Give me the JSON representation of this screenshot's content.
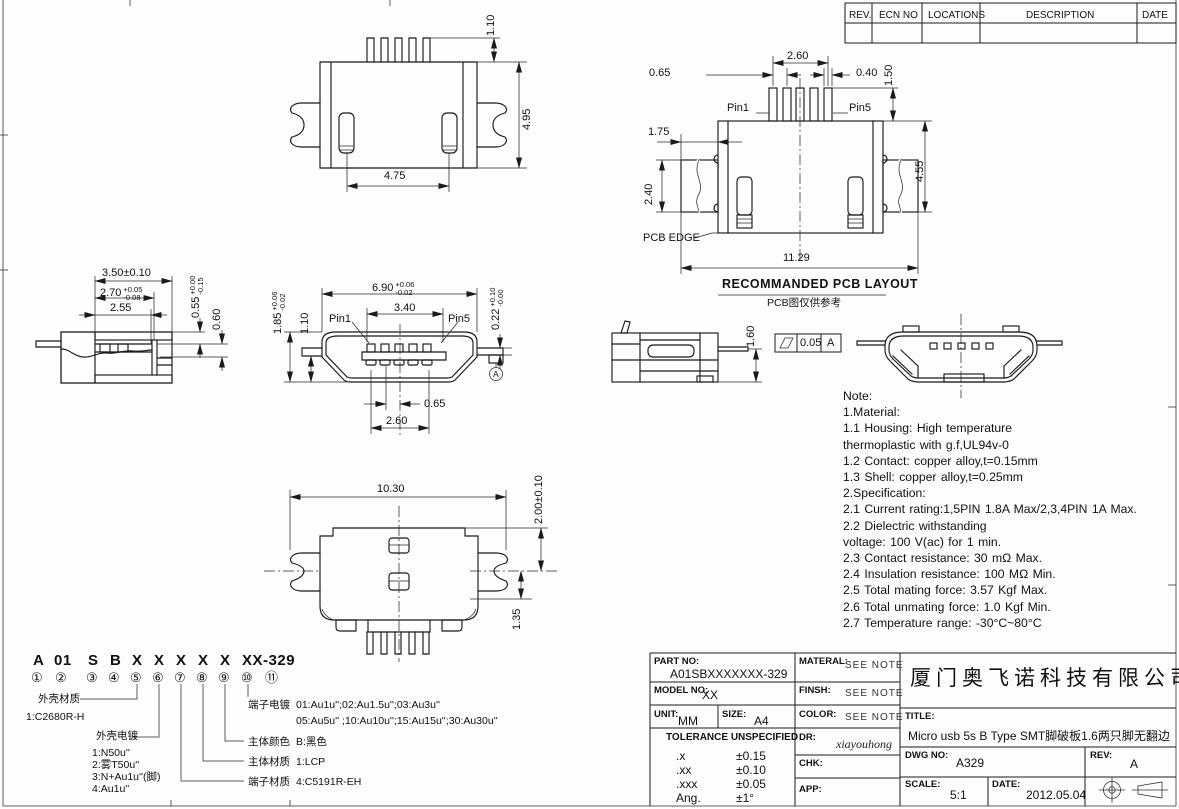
{
  "revision_table": {
    "headers": [
      "REV.",
      "ECN NO",
      "LOCATIONS",
      "DESCRIPTION",
      "DATE"
    ]
  },
  "views": {
    "top": {
      "pin_protrusion": "1.10",
      "depth": "4.95",
      "slot_span": "4.75"
    },
    "section": {
      "width": "3.50±0.10",
      "inner_width": "2.70",
      "inner_width_up": "+0.05",
      "inner_width_dn": "-0.08",
      "cavity_width": "2.55",
      "contact_offset": "0.55",
      "contact_offset_up": "+0.00",
      "contact_offset_dn": "-0.15",
      "contact_height": "0.60"
    },
    "front": {
      "width": "6.90",
      "width_up": "+0.06",
      "width_dn": "-0.02",
      "contact_span": "3.40",
      "pin1": "Pin1",
      "pin5": "Pin5",
      "height": "1.85",
      "height_up": "+0.06",
      "height_dn": "-0.02",
      "leg_offset": "1.10",
      "leg_step": "0.22",
      "leg_step_up": "+0.10",
      "leg_step_dn": "-0.00",
      "pitch": "0.65",
      "pitch_span": "2.60",
      "datum": "A"
    },
    "pcb": {
      "pad_span": "2.60",
      "pad_pitch": "0.65",
      "pad_width": "0.40",
      "pad_height": "1.50",
      "pin1": "Pin1",
      "pin5": "Pin5",
      "side_pad_offset": "1.75",
      "side_pad_height": "2.40",
      "depth": "4.55",
      "total_width": "11.29",
      "edge_label": "PCB EDGE",
      "caption": "RECOMMANDED PCB LAYOUT",
      "caption_cn": "PCB图仅供参考"
    },
    "side": {
      "height": "1.60",
      "flatness": "0.05",
      "datum": "A"
    },
    "bottom": {
      "width": "10.30",
      "depth_a": "2.00±0.10",
      "depth_b": "1.35"
    }
  },
  "notes": {
    "lines": [
      "Note:",
      "1.Material:",
      "   1.1 Housing: High temperature",
      "        thermoplastic with g.f,UL94v-0",
      "   1.2 Contact: copper alloy,t=0.15mm",
      "   1.3 Shell: copper alloy,t=0.25mm",
      "2.Specification:",
      "   2.1 Current rating:1,5PIN 1.8A Max/2,3,4PIN 1A Max.",
      "   2.2 Dielectric withstanding",
      "         voltage: 100 V(ac) for 1 min.",
      "   2.3 Contact resistance: 30 mΩ Max.",
      "   2.4 Insulation resistance: 100 MΩ Min.",
      "   2.5 Total mating force: 3.57 Kgf Max.",
      "   2.6 Total unmating force: 1.0 Kgf Min.",
      "   2.7 Temperature range: -30°C~80°C"
    ]
  },
  "part_code": {
    "segments": [
      "A",
      "01",
      "S",
      "B",
      "X",
      "X",
      "X",
      "X",
      "X",
      "XX-329"
    ],
    "digits": [
      "①",
      "②",
      "③",
      "④",
      "⑤",
      "⑥",
      "⑦",
      "⑧",
      "⑨",
      "⑩",
      "⑪"
    ],
    "legend": {
      "shell_material_label": "外壳材质",
      "shell_material_value": "1:C2680R-H",
      "shell_plating_label": "外壳电镀",
      "shell_plating_1": "1:N50u''",
      "shell_plating_2": "2:雾T50u''",
      "shell_plating_3": "3:N+Au1u''(脚)",
      "shell_plating_4": "4:Au1u''",
      "terminal_plating_label": "端子电镀",
      "terminal_plating_line1": "01:Au1u'';02:Au1.5u'';03:Au3u''",
      "terminal_plating_line2": "05:Au5u'' ;10:Au10u'';15:Au15u'';30:Au30u''",
      "body_color_label": "主体颜色",
      "body_color_value": "B:黑色",
      "body_material_label": "主体材质",
      "body_material_value": "1:LCP",
      "terminal_material_label": "端子材质",
      "terminal_material_value": "4:C5191R-EH"
    }
  },
  "title_block": {
    "part_no_label": "PART NO:",
    "part_no": "A01SBXXXXXXX-329",
    "model_no_label": "MODEL NO:",
    "model_no": "XX",
    "unit_label": "UNIT:",
    "unit": "MM",
    "size_label": "SIZE:",
    "size": "A4",
    "material_label": "MATERAL:",
    "material": "SEE NOTE",
    "finish_label": "FINSH:",
    "finish": "SEE NOTE",
    "color_label": "COLOR:",
    "color": "SEE NOTE",
    "tolerance_title": "TOLERANCE UNSPECIFIED",
    "tolerance_rows": [
      [
        ".x",
        "±0.15"
      ],
      [
        ".xx",
        "±0.10"
      ],
      [
        ".xxx",
        "±0.05"
      ],
      [
        "Ang.",
        "±1°"
      ]
    ],
    "dr_label": "DR:",
    "dr": "xiayouhong",
    "chk_label": "CHK:",
    "app_label": "APP:",
    "company": "厦门奥飞诺科技有限公司",
    "title_label": "TITLE:",
    "title": "Micro usb 5s B Type SMT脚破板1.6两只脚无翻边",
    "dwg_no_label": "DWG NO:",
    "dwg_no": "A329",
    "rev_label": "REV:",
    "rev": "A",
    "scale_label": "SCALE:",
    "scale": "5:1",
    "date_label": "DATE:",
    "date": "2012.05.04"
  }
}
